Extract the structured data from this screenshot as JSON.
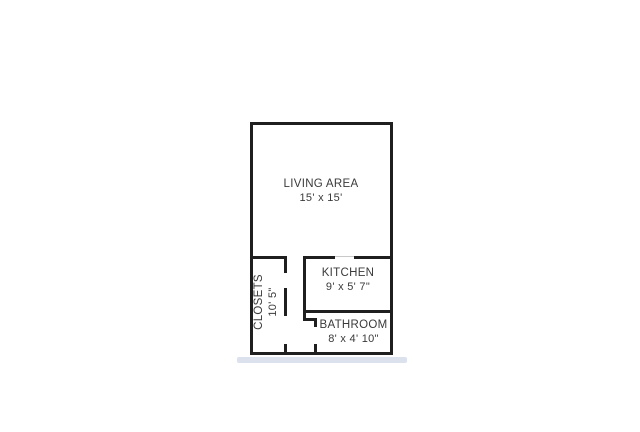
{
  "rooms": {
    "living": {
      "label": "LIVING AREA",
      "dims": "15' x 15'"
    },
    "kitchen": {
      "label": "KITCHEN",
      "dims": "9' x 5' 7\""
    },
    "bathroom": {
      "label": "BATHROOM",
      "dims": "8' x 4' 10\""
    },
    "closets": {
      "label": "CLOSETS",
      "dims": "10' 5\""
    }
  },
  "colors": {
    "wall": "#1f1f1f",
    "label_text": "#3a3a3a",
    "shadow": "#dbe2ee",
    "background": "#ffffff"
  }
}
